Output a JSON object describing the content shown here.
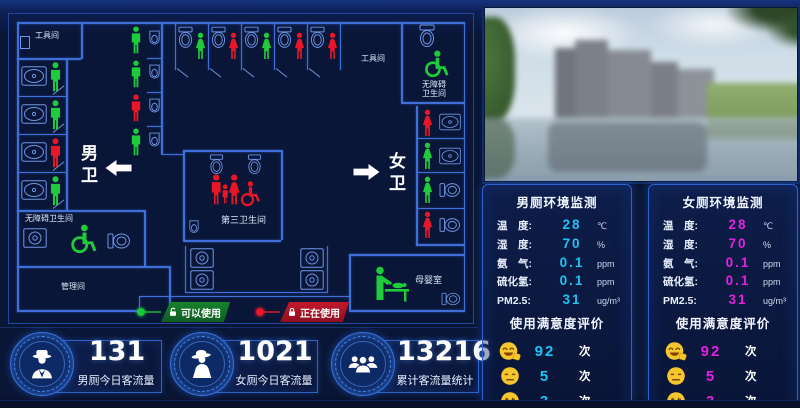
{
  "floorplan": {
    "rooms": {
      "tool_room_left": "工具间",
      "tool_room_right": "工具间",
      "accessible_left": "无障碍卫生间",
      "accessible_right_line1": "无障碍",
      "accessible_right_line2": "卫生间",
      "management_room": "管理间",
      "third_restroom": "第三卫生间",
      "mother_baby_room": "母婴室",
      "male_area": "男卫",
      "female_area": "女卫"
    },
    "occupancy": {
      "male_left_stalls": [
        "free",
        "free",
        "occupied",
        "free"
      ],
      "male_urinals": [
        "free",
        "free",
        "occupied",
        "free"
      ],
      "female_top_stalls": [
        "free",
        "occupied",
        "free",
        "occupied",
        "occupied"
      ],
      "female_right_stalls": [
        "occupied",
        "free",
        "free",
        "occupied"
      ],
      "accessible_left": "free",
      "accessible_right": "free",
      "third_restroom": "occupied",
      "mother_baby": "free"
    },
    "legend": {
      "available": "可以使用",
      "in_use": "正在使用"
    }
  },
  "stats": [
    {
      "value": "131",
      "label": "男厕今日客流量",
      "icon": "male-visitor-icon"
    },
    {
      "value": "1021",
      "label": "女厕今日客流量",
      "icon": "female-visitor-icon"
    },
    {
      "value": "13216",
      "label": "累计客流量统计",
      "icon": "group-visitor-icon"
    }
  ],
  "panels": [
    {
      "title": "男厕环境监测",
      "accent": "#1fc4f2",
      "metrics": [
        {
          "label": "温　度:",
          "value": "28",
          "unit": "℃"
        },
        {
          "label": "湿　度:",
          "value": "70",
          "unit": "%"
        },
        {
          "label": "氨　气:",
          "value": "0.1",
          "unit": "ppm"
        },
        {
          "label": "硫化氢:",
          "value": "0.1",
          "unit": "ppm"
        },
        {
          "label": "PM2.5:",
          "value": "31",
          "unit": "ug/m³"
        }
      ],
      "satisfaction_title": "使用满意度评价",
      "ratings": [
        {
          "mood": "happy",
          "value": "92",
          "unit": "次"
        },
        {
          "mood": "neutral",
          "value": "5",
          "unit": "次"
        },
        {
          "mood": "sad",
          "value": "3",
          "unit": "次"
        }
      ]
    },
    {
      "title": "女厕环境监测",
      "accent": "#e520de",
      "metrics": [
        {
          "label": "温　度:",
          "value": "28",
          "unit": "℃"
        },
        {
          "label": "湿　度:",
          "value": "70",
          "unit": "%"
        },
        {
          "label": "氨　气:",
          "value": "0.1",
          "unit": "ppm"
        },
        {
          "label": "硫化氢:",
          "value": "0.1",
          "unit": "ppm"
        },
        {
          "label": "PM2.5:",
          "value": "31",
          "unit": "ug/m³"
        }
      ],
      "satisfaction_title": "使用满意度评价",
      "ratings": [
        {
          "mood": "happy",
          "value": "92",
          "unit": "次"
        },
        {
          "mood": "neutral",
          "value": "5",
          "unit": "次"
        },
        {
          "mood": "sad",
          "value": "3",
          "unit": "次"
        }
      ]
    }
  ],
  "colors": {
    "available_green": "#1ecb3a",
    "occupied_red": "#e81626",
    "male_accent": "#1fc4f2",
    "female_accent": "#e520de",
    "blueprint_line": "#3f6fd8"
  }
}
